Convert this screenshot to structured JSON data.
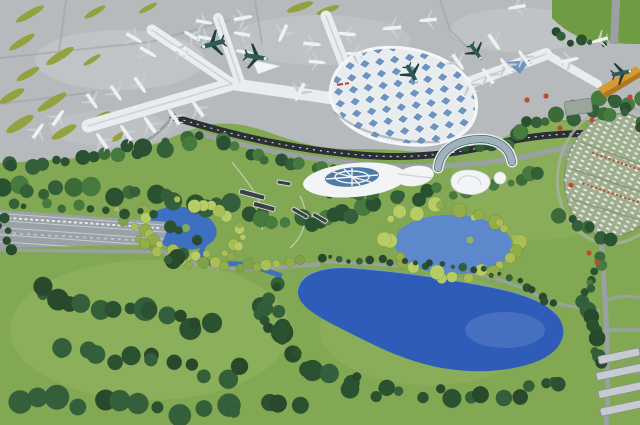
{
  "image": {
    "title": "Aerial architectural rendering of an airport: X-shaped terminal with parked aircraft on a gray apron, landscaped park, winding roads, and blue lakes",
    "roof_sign_note": "small red sign on terminal roof (illegible)"
  },
  "colors": {
    "apron": "#b7babc",
    "apron_light": "#cbced0",
    "taxiway": "#9fa3a6",
    "grass_island": "#93a23f",
    "grass_bright": "#6f9c42",
    "meadow": "#83a854",
    "meadow_light": "#93b560",
    "forest_dark": "#2b5230",
    "forest_mid": "#477a3e",
    "foliage_yellow": "#a9bf56",
    "lake_deep": "#2e5cb8",
    "lake_mid": "#3f6fc0",
    "lake_light": "#5d88cc",
    "shoreline": "#7fa3da",
    "terminal_roof": "#e8ecef",
    "concourse": "#e9edf0",
    "concourse_line": "#cdd3d7",
    "skylight": "#6d94bf",
    "dark_road": "#2b3034",
    "road": "#9aa1a5",
    "orange_pier": "#d89a33",
    "orange_pier_dark": "#b07822",
    "glass_blue": "#4e7aa6",
    "hotel_glass": "#2e4f66",
    "white_building": "#f2f4f6",
    "building_edge": "#ccd2d6",
    "parking_asphalt": "#9aa1a7",
    "parking_stripe": "#d8dcde",
    "parking_oval": "#9fae8d",
    "car_white": "#e8ecef",
    "plane_white": "#eef1f3",
    "plane_wing": "#c6cdd3",
    "plane_teal": "#2f5a57",
    "plane_teal_wing": "#223f3d",
    "eco_building": "#3a4147",
    "accent_red": "#bf4a33",
    "roof_sign_red": "#c23b2f"
  },
  "planes": [
    [
      102,
      141,
      -35,
      1,
      "w"
    ],
    [
      126,
      133,
      -35,
      1,
      "w"
    ],
    [
      150,
      125,
      -35,
      1.05,
      "w"
    ],
    [
      174,
      117,
      -35,
      1,
      "w"
    ],
    [
      198,
      109,
      -35,
      1,
      "w"
    ],
    [
      92,
      101,
      145,
      0.95,
      "w"
    ],
    [
      116,
      93,
      145,
      0.95,
      "w"
    ],
    [
      140,
      85,
      145,
      1,
      "w"
    ],
    [
      148,
      52,
      120,
      1,
      "w"
    ],
    [
      134,
      38,
      120,
      0.95,
      "w"
    ],
    [
      178,
      50,
      -60,
      1,
      "w"
    ],
    [
      192,
      36,
      -60,
      0.95,
      "w"
    ],
    [
      206,
      38,
      100,
      0.9,
      "w"
    ],
    [
      204,
      22,
      100,
      0.9,
      "w"
    ],
    [
      242,
      34,
      -80,
      0.9,
      "w"
    ],
    [
      244,
      52,
      -80,
      0.9,
      "w"
    ],
    [
      213,
      44,
      255,
      1.3,
      "t"
    ],
    [
      256,
      57,
      100,
      1.25,
      "t"
    ],
    [
      243,
      18,
      80,
      1,
      "w"
    ],
    [
      283,
      33,
      205,
      1,
      "w"
    ],
    [
      300,
      92,
      205,
      1.05,
      "w"
    ],
    [
      312,
      44,
      95,
      0.95,
      "w"
    ],
    [
      317,
      62,
      95,
      0.9,
      "w"
    ],
    [
      347,
      34,
      -85,
      0.95,
      "w"
    ],
    [
      354,
      54,
      -85,
      0.9,
      "w"
    ],
    [
      392,
      28,
      -95,
      1,
      "w"
    ],
    [
      428,
      20,
      -95,
      0.95,
      "w"
    ],
    [
      517,
      7,
      -100,
      0.95,
      "w"
    ],
    [
      458,
      62,
      145,
      1,
      "w"
    ],
    [
      476,
      52,
      145,
      1,
      "t"
    ],
    [
      494,
      42,
      145,
      1,
      "w"
    ],
    [
      412,
      74,
      150,
      1.1,
      "t"
    ],
    [
      470,
      86,
      -35,
      1,
      "w"
    ],
    [
      488,
      76,
      -35,
      1,
      "w"
    ],
    [
      506,
      66,
      -35,
      1,
      "w"
    ],
    [
      524,
      58,
      -35,
      0.95,
      "w"
    ],
    [
      570,
      60,
      78,
      0.95,
      "w"
    ],
    [
      600,
      40,
      255,
      0.9,
      "w"
    ],
    [
      622,
      73,
      78,
      1.1,
      "t"
    ],
    [
      58,
      118,
      35,
      1,
      "w"
    ],
    [
      38,
      131,
      35,
      0.95,
      "w"
    ]
  ],
  "grass_islands": [
    [
      30,
      14,
      16,
      3.5,
      -30
    ],
    [
      95,
      12,
      12,
      3,
      -30
    ],
    [
      148,
      8,
      10,
      2.5,
      -28
    ],
    [
      22,
      42,
      15,
      3.5,
      -32
    ],
    [
      60,
      56,
      16,
      4,
      -32
    ],
    [
      28,
      74,
      13,
      3.5,
      -30
    ],
    [
      12,
      96,
      14,
      4,
      -30
    ],
    [
      52,
      102,
      17,
      4,
      -32
    ],
    [
      20,
      124,
      16,
      4.5,
      -32
    ],
    [
      64,
      132,
      14,
      4,
      -30
    ],
    [
      100,
      118,
      12,
      3.5,
      -30
    ],
    [
      300,
      7,
      14,
      3.5,
      -20
    ],
    [
      328,
      10,
      12,
      3,
      -20
    ],
    [
      92,
      60,
      10,
      2.5,
      -32
    ],
    [
      120,
      136,
      10,
      3,
      -30
    ]
  ],
  "tree_bands": [
    {
      "pts": [
        [
          5,
          168
        ],
        [
          50,
          160
        ],
        [
          95,
          153
        ],
        [
          140,
          149
        ],
        [
          185,
          143
        ],
        [
          228,
          138
        ]
      ],
      "n": 20,
      "r": 6.5,
      "pal": "mix"
    },
    {
      "pts": [
        [
          8,
          186
        ],
        [
          50,
          194
        ],
        [
          95,
          190
        ],
        [
          140,
          196
        ],
        [
          185,
          202
        ],
        [
          225,
          208
        ]
      ],
      "n": 18,
      "r": 7,
      "pal": "mix"
    },
    {
      "pts": [
        [
          238,
          150
        ],
        [
          272,
          158
        ],
        [
          306,
          166
        ],
        [
          338,
          173
        ]
      ],
      "n": 12,
      "r": 6,
      "pal": "mix"
    },
    {
      "pts": [
        [
          470,
          151
        ],
        [
          505,
          139
        ],
        [
          540,
          123
        ],
        [
          574,
          109
        ],
        [
          608,
          100
        ],
        [
          636,
          100
        ]
      ],
      "n": 18,
      "r": 6.5,
      "pal": "mix"
    },
    {
      "pts": [
        [
          250,
          212
        ],
        [
          280,
          218
        ],
        [
          310,
          222
        ],
        [
          345,
          215
        ],
        [
          378,
          209
        ]
      ],
      "n": 14,
      "r": 6.5,
      "pal": "mix"
    },
    {
      "pts": [
        [
          142,
          210
        ],
        [
          150,
          236
        ],
        [
          166,
          252
        ],
        [
          196,
          258
        ],
        [
          226,
          254
        ],
        [
          244,
          243
        ],
        [
          234,
          222
        ],
        [
          212,
          206
        ],
        [
          180,
          200
        ]
      ],
      "n": 24,
      "r": 5,
      "pal": "yg"
    },
    {
      "pts": [
        [
          392,
          216
        ],
        [
          424,
          208
        ],
        [
          456,
          210
        ],
        [
          486,
          216
        ],
        [
          508,
          228
        ],
        [
          516,
          246
        ],
        [
          504,
          263
        ],
        [
          478,
          273
        ],
        [
          448,
          276
        ],
        [
          418,
          270
        ],
        [
          398,
          256
        ],
        [
          390,
          236
        ]
      ],
      "n": 28,
      "r": 5.5,
      "pal": "yg"
    },
    {
      "pts": [
        [
          322,
          259
        ],
        [
          352,
          259
        ],
        [
          384,
          261
        ],
        [
          416,
          263
        ],
        [
          448,
          266
        ],
        [
          478,
          270
        ],
        [
          508,
          278
        ],
        [
          534,
          290
        ],
        [
          552,
          304
        ]
      ],
      "n": 26,
      "r": 3.2,
      "pal": "dark"
    },
    {
      "pts": [
        [
          118,
          212
        ],
        [
          140,
          238
        ],
        [
          164,
          256
        ],
        [
          196,
          264
        ],
        [
          232,
          268
        ],
        [
          268,
          266
        ],
        [
          302,
          263
        ]
      ],
      "n": 20,
      "r": 4.2,
      "pal": "ygmid"
    },
    {
      "pts": [
        [
          40,
          290
        ],
        [
          82,
          300
        ],
        [
          126,
          312
        ],
        [
          170,
          319
        ],
        [
          214,
          326
        ]
      ],
      "n": 15,
      "r": 9,
      "pal": "dark"
    },
    {
      "pts": [
        [
          58,
          346
        ],
        [
          100,
          356
        ],
        [
          145,
          363
        ],
        [
          190,
          369
        ],
        [
          236,
          373
        ]
      ],
      "n": 13,
      "r": 9.5,
      "pal": "dark"
    },
    {
      "pts": [
        [
          28,
          396
        ],
        [
          80,
          403
        ],
        [
          135,
          409
        ],
        [
          190,
          411
        ],
        [
          246,
          408
        ],
        [
          300,
          401
        ]
      ],
      "n": 15,
      "r": 9,
      "pal": "dark"
    },
    {
      "pts": [
        [
          256,
          300
        ],
        [
          276,
          322
        ],
        [
          292,
          346
        ],
        [
          312,
          366
        ],
        [
          338,
          381
        ],
        [
          368,
          391
        ]
      ],
      "n": 13,
      "r": 8,
      "pal": "dark"
    },
    {
      "pts": [
        [
          276,
          280
        ],
        [
          268,
          300
        ],
        [
          272,
          318
        ],
        [
          286,
          336
        ]
      ],
      "n": 9,
      "r": 7,
      "pal": "dark"
    },
    {
      "pts": [
        [
          362,
          380
        ],
        [
          402,
          390
        ],
        [
          446,
          396
        ],
        [
          492,
          396
        ],
        [
          532,
          389
        ],
        [
          566,
          379
        ]
      ],
      "n": 15,
      "r": 7,
      "pal": "dark"
    },
    {
      "pts": [
        [
          578,
          300
        ],
        [
          592,
          320
        ],
        [
          600,
          342
        ],
        [
          602,
          364
        ]
      ],
      "n": 9,
      "r": 6,
      "pal": "dark"
    },
    {
      "pts": [
        [
          568,
          121
        ],
        [
          598,
          109
        ],
        [
          626,
          112
        ],
        [
          640,
          126
        ]
      ],
      "n": 9,
      "r": 5.5,
      "pal": "mix"
    },
    {
      "pts": [
        [
          564,
          214
        ],
        [
          586,
          228
        ],
        [
          608,
          237
        ]
      ],
      "n": 7,
      "r": 5.5,
      "pal": "mix"
    },
    {
      "pts": [
        [
          176,
          228
        ],
        [
          194,
          242
        ],
        [
          186,
          256
        ],
        [
          166,
          260
        ]
      ],
      "n": 8,
      "r": 6,
      "pal": "dark"
    },
    {
      "pts": [
        [
          10,
          206
        ],
        [
          60,
          206
        ],
        [
          110,
          210
        ],
        [
          150,
          215
        ]
      ],
      "n": 10,
      "r": 4,
      "pal": "mix"
    },
    {
      "pts": [
        [
          322,
          190
        ],
        [
          354,
          196
        ],
        [
          386,
          198
        ],
        [
          418,
          195
        ],
        [
          448,
          191
        ],
        [
          478,
          187
        ],
        [
          510,
          181
        ],
        [
          542,
          172
        ]
      ],
      "n": 20,
      "r": 5.5,
      "pal": "mix"
    },
    {
      "pts": [
        [
          4,
          214
        ],
        [
          4,
          232
        ],
        [
          8,
          250
        ]
      ],
      "n": 5,
      "r": 5,
      "pal": "dark"
    },
    {
      "pts": [
        [
          602,
          256
        ],
        [
          596,
          276
        ],
        [
          590,
          294
        ]
      ],
      "n": 7,
      "r": 5,
      "pal": "mix"
    },
    {
      "pts": [
        [
          552,
          34
        ],
        [
          576,
          42
        ],
        [
          600,
          46
        ]
      ],
      "n": 6,
      "r": 4,
      "pal": "dark"
    }
  ],
  "palettes": {
    "dark": [
      "#2b5230",
      "#33603a",
      "#28492c"
    ],
    "mix": [
      "#2b5230",
      "#477a3e",
      "#33603a",
      "#3c6b37"
    ],
    "yg": [
      "#a9bf56",
      "#93ad4b",
      "#b8cc66"
    ],
    "ygmid": [
      "#7fa24a",
      "#93ad4b",
      "#a9bf56"
    ]
  },
  "red_trees": [
    [
      527,
      100
    ],
    [
      546,
      96
    ],
    [
      560,
      128
    ],
    [
      592,
      120
    ],
    [
      630,
      97
    ],
    [
      571,
      185
    ],
    [
      589,
      253
    ],
    [
      597,
      262
    ]
  ]
}
